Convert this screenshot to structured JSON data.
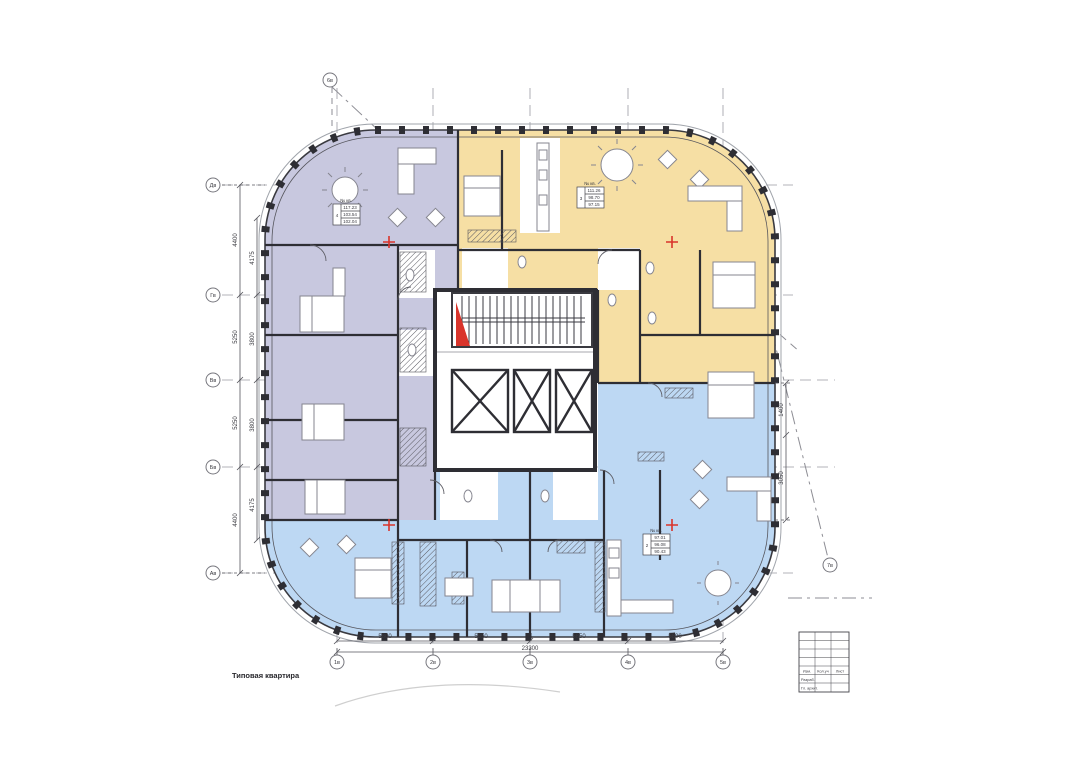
{
  "drawing": {
    "caption": "Типовая квартира",
    "axes": {
      "left": [
        "Дв",
        "Гв",
        "Вв",
        "Бв",
        "Ав"
      ],
      "bottom": [
        "1в",
        "2в",
        "3в",
        "4в",
        "5в"
      ],
      "top_radial": "6в",
      "right_radial": "7в"
    },
    "dimensions": {
      "bottom_segments": [
        "5800",
        "5850",
        "5850",
        "5800"
      ],
      "bottom_total": "23300",
      "left_segments": [
        "4400",
        "5250",
        "5250",
        "4400"
      ],
      "left_inner": [
        "4175",
        "3800",
        "3800",
        "4175"
      ],
      "right_segments": [
        "1400",
        "3050"
      ]
    },
    "stamps": {
      "header": "№ кв.",
      "purple": {
        "number": "4",
        "values": [
          "117.23",
          "103.54",
          "102.04"
        ]
      },
      "yellow": {
        "number": "3",
        "values": [
          "111.26",
          "98.70",
          "97.15"
        ]
      },
      "blue": {
        "number": "2",
        "values": [
          "97.01",
          "96.08",
          "90.43"
        ]
      }
    },
    "title_block": {
      "row_labels": [
        "Изм.",
        "Кол.уч",
        "Лист"
      ],
      "row2_label": "Разраб.",
      "row3_label": "Гл. архит."
    },
    "colors": {
      "zone_purple": "#c8c8df",
      "zone_yellow": "#f6dfa4",
      "zone_blue": "#bdd8f3",
      "wall": "#2e2e34",
      "accent_red": "#d9342b"
    }
  }
}
